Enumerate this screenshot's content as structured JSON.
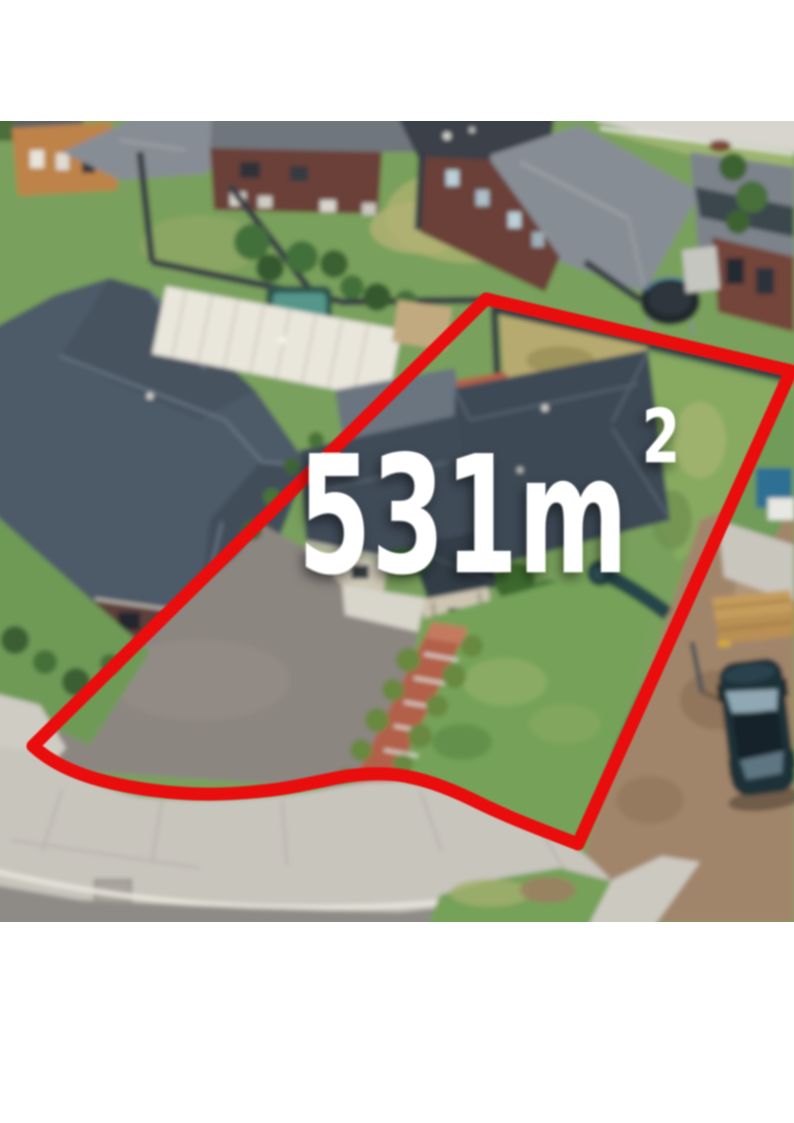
{
  "page": {
    "background": "#ffffff"
  },
  "overlay": {
    "area_value": "531m",
    "area_exponent": "2",
    "area_label_full": "531m²",
    "boundary_color": "#e9100e",
    "label_color": "#ffffff"
  },
  "photo": {
    "kind": "aerial-drone-photograph",
    "subject": "single-storey brick house with dark tiled roof, front lawn, terracotta garden path and long driveway on a suburban block outlined in red",
    "palette": {
      "roof_dark": "#3d4854",
      "roof_wing": "#414c58",
      "roof_neighbor": "#4d5a68",
      "roof_light": "#878d94",
      "roof_gray": "#70767d",
      "roof_charcoal": "#3a4149",
      "brick": "#6b4037",
      "grass": "#79a05c",
      "lawn": "#74a259",
      "dry_grass": "#b7aa70",
      "driveway": "#8c8681",
      "road_concrete": "#c8c5bd",
      "asphalt": "#8e8b86",
      "dirt": "#a1856a",
      "path_terracotta": "#b2604a",
      "pergola_white": "#e9e6dc",
      "pebbles_white": "#d8d5cb",
      "fence_dark": "#383e44",
      "pool_teal": "#55968a",
      "car_dark": "#1f3039",
      "orange_house": "#bd8348"
    }
  }
}
